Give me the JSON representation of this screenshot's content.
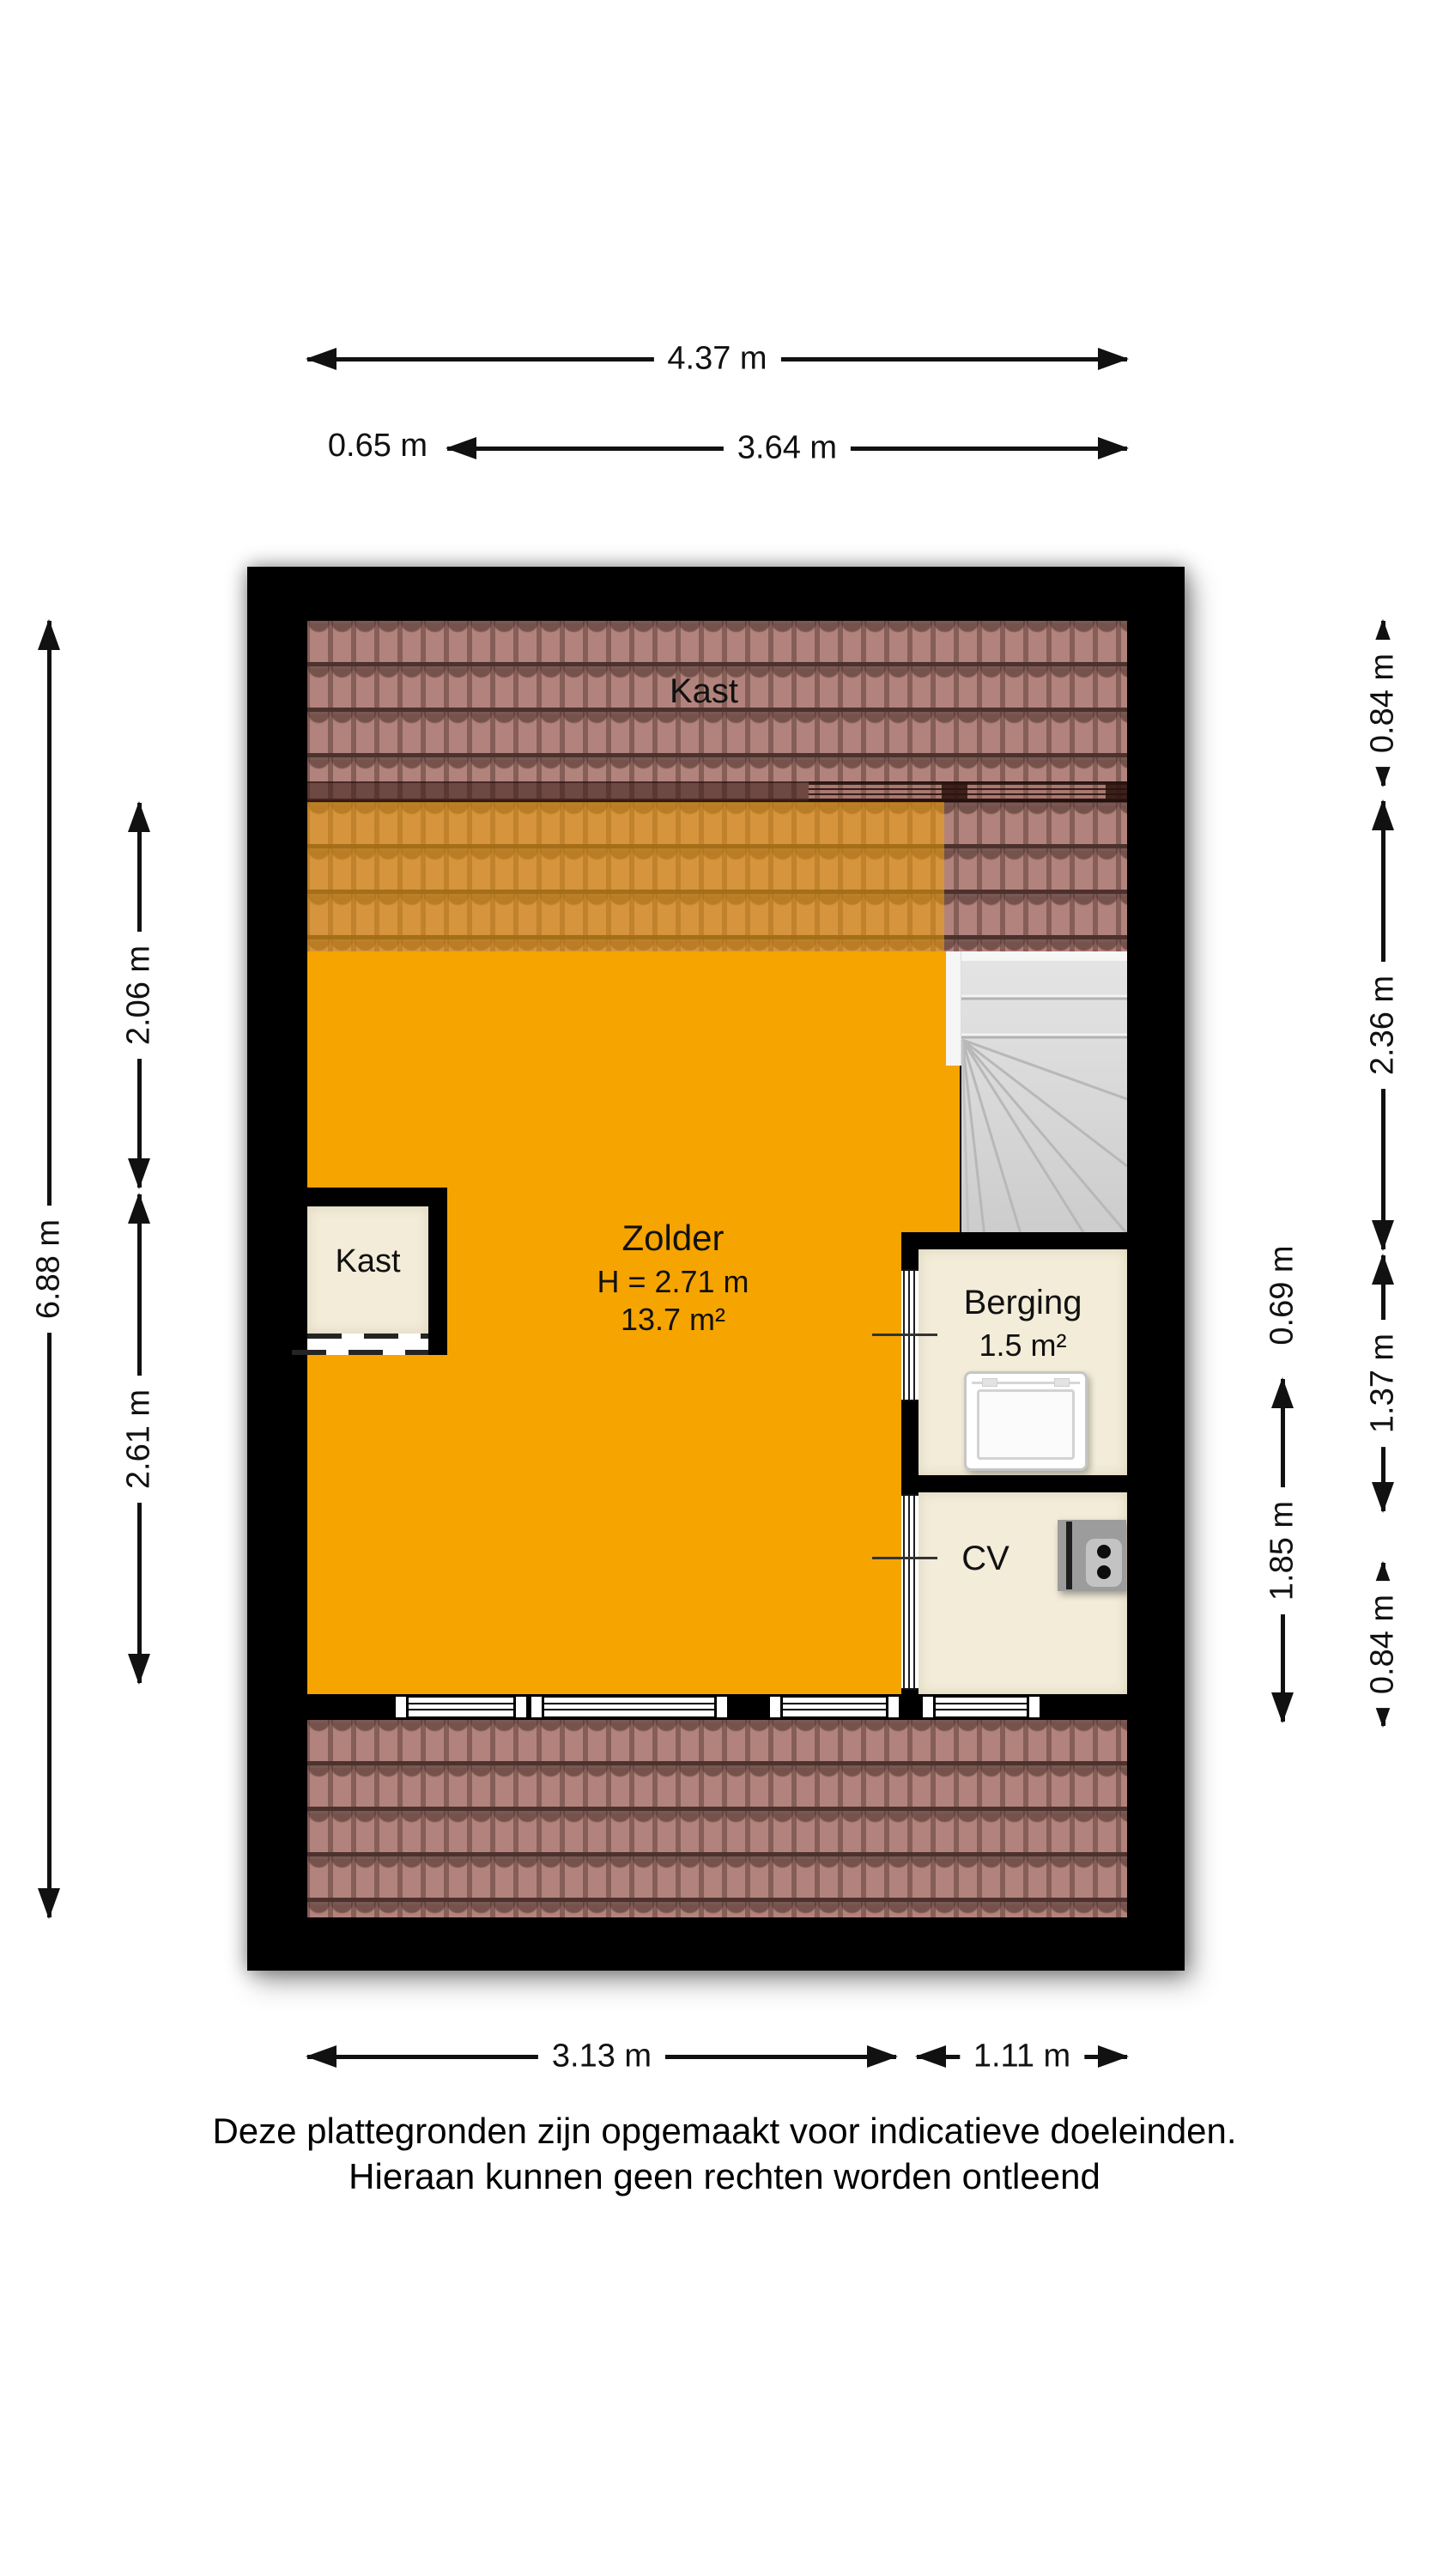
{
  "colors": {
    "wall": "#000000",
    "floor_orange": "#F6A400",
    "roof_tile": "#B2837C",
    "room_cream": "#F2ECD8",
    "stair_gray": "#D9D9D9"
  },
  "dims": {
    "top_overall": "4.37 m",
    "top_left_offset": "0.65 m",
    "top_main": "3.64 m",
    "left_overall": "6.88 m",
    "left_upper": "2.06 m",
    "left_lower": "2.61 m",
    "right_inner_upper": "0.69 m",
    "right_inner_lower": "1.85 m",
    "right_outer_top": "0.84 m",
    "right_outer_upper": "2.36 m",
    "right_outer_middle": "1.37 m",
    "right_outer_bottom": "0.84 m",
    "bottom_left": "3.13 m",
    "bottom_right": "1.11 m"
  },
  "rooms": {
    "kast_top": "Kast",
    "kast_closet": "Kast",
    "zolder": "Zolder",
    "zolder_height": "H = 2.71 m",
    "zolder_area": "13.7 m²",
    "berging": "Berging",
    "berging_area": "1.5 m²",
    "cv": "CV"
  },
  "icons": {
    "washing_machine": "washing-machine-icon",
    "boiler": "cv-boiler-icon",
    "staircase": "staircase-winder"
  },
  "disclaimer": {
    "line1": "Deze plattegronden zijn opgemaakt voor indicatieve doeleinden.",
    "line2": "Hieraan kunnen geen rechten worden ontleend"
  }
}
